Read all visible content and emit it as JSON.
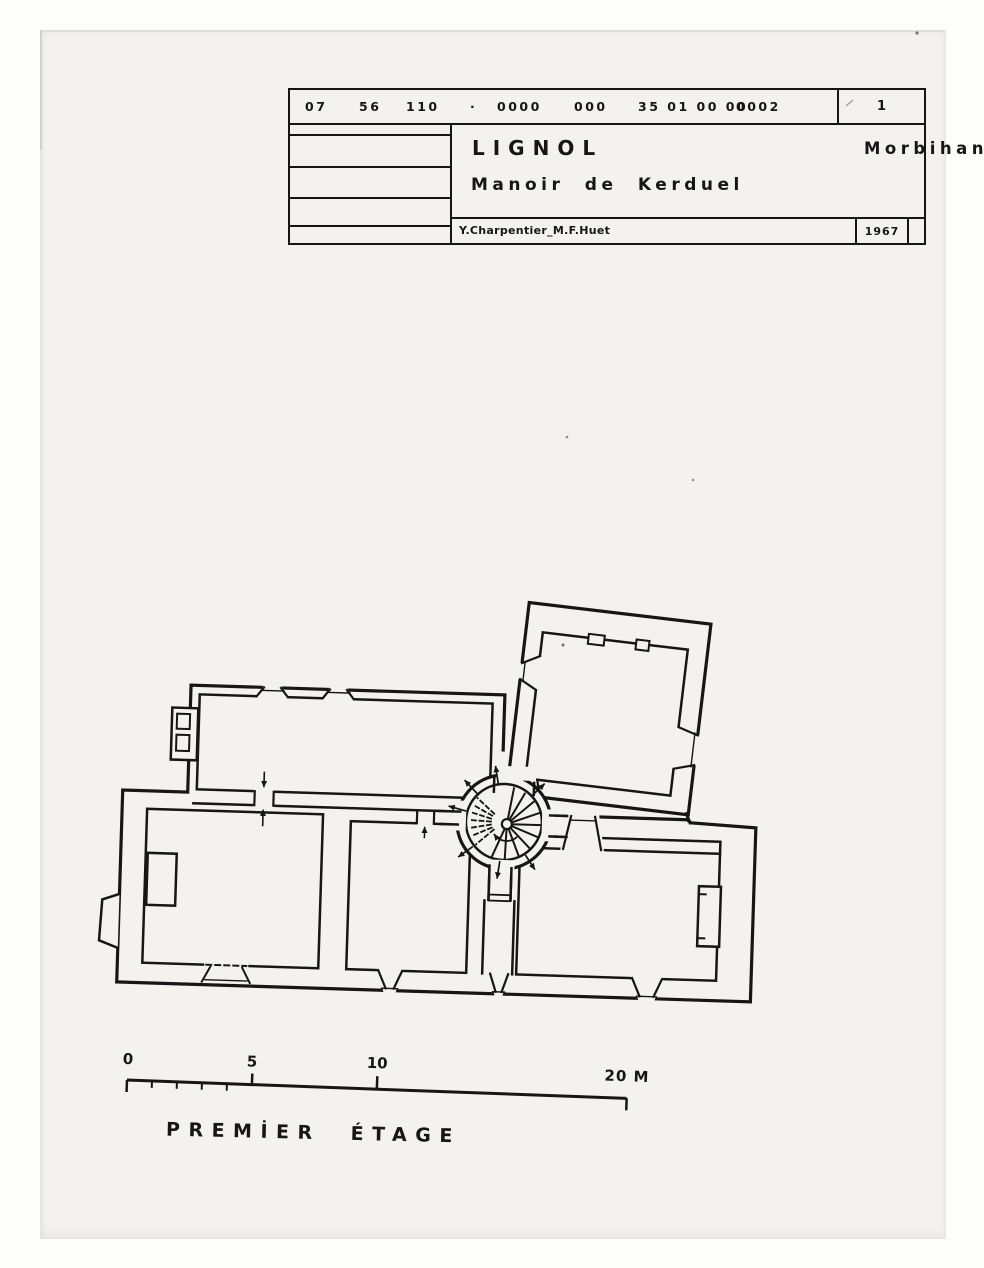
{
  "title_block": {
    "codes": [
      "07",
      "56",
      "110",
      "·",
      "0000",
      "000",
      "35 01 00 00",
      "0002"
    ],
    "sheet_number": "1",
    "commune": "LIGNOL",
    "department": "Morbihan",
    "building_title": "Manoir de Kerduel",
    "authors": "Y.Charpentier_M.F.Huet",
    "year": "1967"
  },
  "scale_bar": {
    "tick_labels": {
      "t0": "0",
      "t5": "5",
      "t10": "10",
      "t20": "20 M"
    }
  },
  "caption": {
    "word1": "PREMİER",
    "word2": "ÉTAGE"
  },
  "plan": {
    "features": [
      "west-wing-hall",
      "north-east-wing-room",
      "south-west-room",
      "central-room",
      "south-east-room",
      "central-spiral-staircase",
      "garderobe",
      "fireplace-west",
      "fireplace-east",
      "splayed-windows",
      "corridor-south",
      "door-arrows"
    ]
  },
  "colors": {
    "ink": "#161616",
    "paper": "#f3f2ef",
    "margin": "#fdfdfc"
  }
}
